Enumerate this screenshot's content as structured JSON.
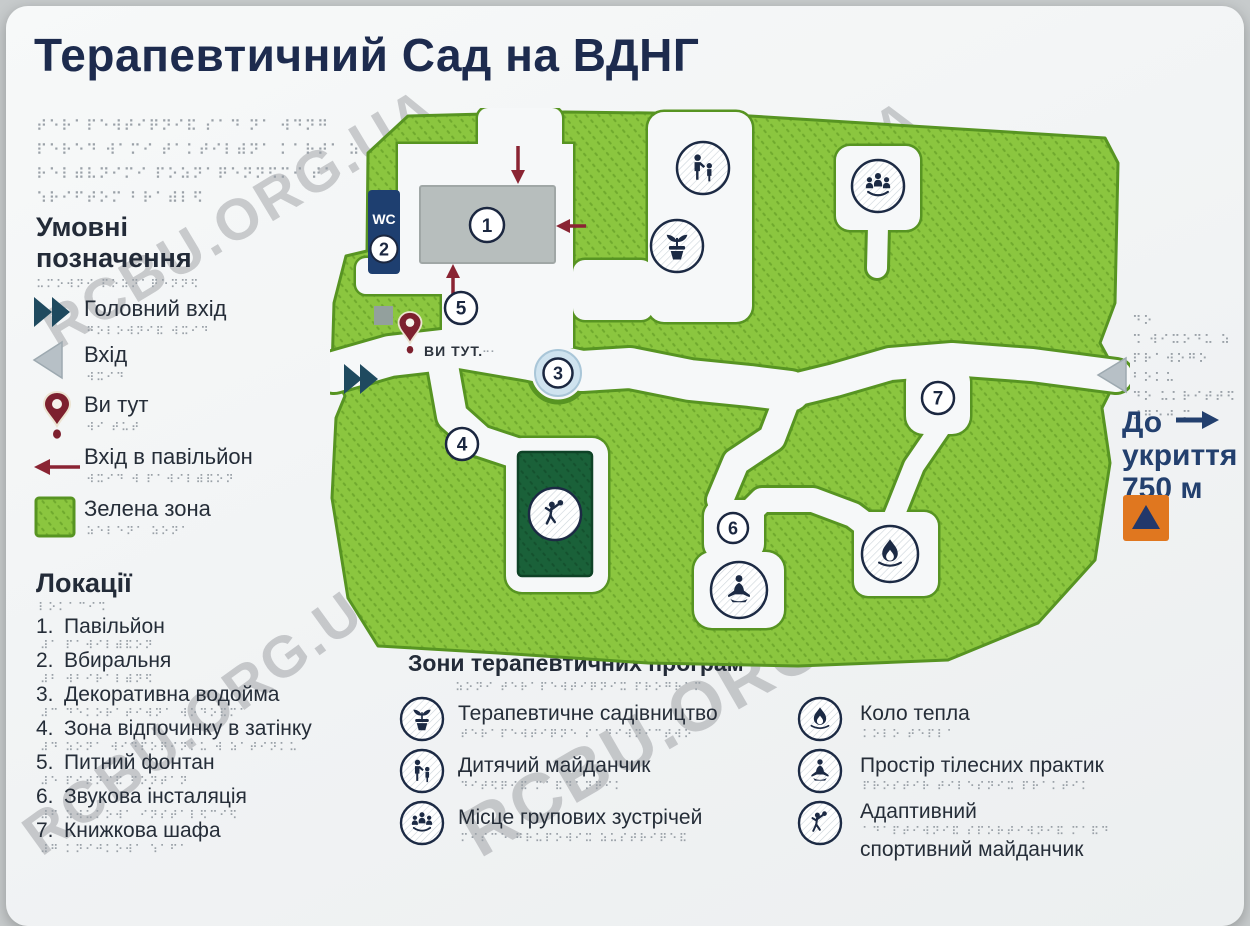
{
  "title": "Терапевтичний Сад на ВДНГ",
  "watermark": {
    "text": "RCBU.ORG.UA"
  },
  "colors": {
    "green_zone": "#8bc63f",
    "green_edge": "#579422",
    "dark_green_lawn": "#1a6139",
    "navy": "#1e3f70",
    "dark_red": "#8a2433",
    "pond_blue": "#cfe3ef",
    "path_white": "#f6f8f9",
    "gray_triangle": "#b7c0c6",
    "building_gray": "#b7bebd",
    "shelter_orange": "#e0771f"
  },
  "legend": {
    "braille_intro": [
      "⠞⠑⠗⠁⠏⠑⠺⠞⠊⠟⠝⠊⠯ ⠎⠁⠙ ⠝⠁ ⠺⠙⠝⠛",
      "⠏⠑⠗⠑⠙ ⠺⠁⠍⠊ ⠞⠁⠅⠞⠊⠇⠾⠝⠁ ⠅⠁⠗⠞⠁ ⠵",
      "⠗⠑⠇⠾⠧⠝⠊⠍⠊ ⠏⠕⠵⠝⠁⠟⠑⠝⠝⠫⠍⠊ ⠞⠁",
      "⠱⠗⠊⠋⠞⠕⠍ ⠃⠗⠁⠾⠇⠫"
    ],
    "heading": "Умовні позначення",
    "heading_braille": "⠥⠍⠕⠺⠝⠊ ⠏⠕⠵⠝⠁⠟⠑⠝⠝⠫",
    "items": [
      {
        "label": "Головний вхід",
        "braille": "⠛⠕⠇⠕⠺⠝⠊⠯ ⠺⠭⠊⠙",
        "icon": "double-arrow-icon"
      },
      {
        "label": "Вхід",
        "braille": "⠺⠭⠊⠙",
        "icon": "gray-triangle-icon"
      },
      {
        "label": "Ви тут",
        "braille": "⠺⠊ ⠞⠥⠞",
        "icon": "map-pin-icon"
      },
      {
        "label": "Вхід в павільйон",
        "braille": "⠺⠭⠊⠙ ⠺ ⠏⠁⠺⠊⠇⠾⠯⠕⠝",
        "icon": "red-arrow-icon"
      },
      {
        "label": "Зелена зона",
        "braille": "⠵⠑⠇⠑⠝⠁ ⠵⠕⠝⠁",
        "icon": "green-square-icon"
      }
    ]
  },
  "locations": {
    "heading": "Локації",
    "heading_braille": "⠇⠕⠅⠁⠉⠊⠩",
    "items": [
      {
        "number": "1.",
        "label": "Павільйон",
        "braille": "⠼⠁ ⠏⠁⠺⠊⠇⠾⠯⠕⠝"
      },
      {
        "number": "2.",
        "label": "Вбиральня",
        "braille": "⠼⠃ ⠺⠃⠊⠗⠁⠇⠾⠝⠫"
      },
      {
        "number": "3.",
        "label": "Декоративна водойма",
        "braille": "⠼⠉ ⠙⠑⠅⠕⠗⠁⠞⠊⠺⠝⠁ ⠺⠕⠙⠕⠯⠍⠁"
      },
      {
        "number": "4.",
        "label": "Зона відпочинку в затінку",
        "braille": "⠼⠙ ⠵⠕⠝⠁ ⠺⠊⠙⠏⠕⠟⠊⠝⠅⠥ ⠺ ⠵⠁⠞⠊⠝⠅⠥"
      },
      {
        "number": "5.",
        "label": "Питний фонтан",
        "braille": "⠼⠑ ⠏⠊⠞⠝⠊⠯ ⠋⠕⠝⠞⠁⠝"
      },
      {
        "number": "6.",
        "label": "Звукова інсталяція",
        "braille": "⠼⠋ ⠵⠺⠥⠅⠕⠺⠁ ⠊⠝⠎⠞⠁⠇⠫⠉⠊⠫"
      },
      {
        "number": "7.",
        "label": "Книжкова шафа",
        "braille": "⠼⠛ ⠅⠝⠊⠚⠅⠕⠺⠁ ⠱⠁⠋⠁"
      }
    ]
  },
  "programs": {
    "heading": "Зони терапевтичних програм",
    "heading_braille": "⠵⠕⠝⠊ ⠞⠑⠗⠁⠏⠑⠺⠞⠊⠟⠝⠊⠭ ⠏⠗⠕⠛⠗⠁⠍",
    "items": [
      {
        "label": "Терапевтичне садівництво",
        "braille": "⠞⠑⠗⠁⠏⠑⠺⠞⠊⠟⠝⠑ ⠎⠁⠙⠊⠺⠝⠊⠉⠞⠺⠕",
        "icon": "plant-pot-icon"
      },
      {
        "label": "Дитячий майданчик",
        "braille": "⠙⠊⠞⠫⠟⠊⠯ ⠍⠁⠯⠙⠁⠝⠟⠊⠅",
        "icon": "children-icon"
      },
      {
        "label": "Місце групових зустрічей",
        "braille": "⠍⠊⠎⠉⠑ ⠛⠗⠥⠏⠕⠺⠊⠭ ⠵⠥⠎⠞⠗⠊⠟⠑⠯",
        "icon": "group-meeting-icon"
      },
      {
        "label": "Коло тепла",
        "braille": "⠅⠕⠇⠕ ⠞⠑⠏⠇⠁",
        "icon": "warmth-fire-icon"
      },
      {
        "label": "Простір тілесних практик",
        "braille": "⠏⠗⠕⠎⠞⠊⠗ ⠞⠊⠇⠑⠎⠝⠊⠭ ⠏⠗⠁⠅⠞⠊⠅",
        "icon": "yoga-icon"
      },
      {
        "label": "Адаптивний",
        "label2": "спортивний майданчик",
        "braille": "⠁⠙⠁⠏⠞⠊⠺⠝⠊⠯ ⠎⠏⠕⠗⠞⠊⠺⠝⠊⠯ ⠍⠁⠯⠙",
        "icon": "adaptive-sport-icon"
      }
    ]
  },
  "shelter": {
    "braille": [
      "⠙⠕",
      "⠩ ⠺⠊⠭⠕⠙⠥ ⠵",
      "⠏⠗⠁⠺⠕⠛⠕ ⠃⠕⠅⠥",
      "⠙⠕ ⠥⠅⠗⠊⠞⠞⠫",
      "⠼⠛⠑⠚ ⠍"
    ],
    "line1": "До",
    "line2": "укриття",
    "line3": "750 м"
  },
  "map": {
    "wc_label": "WC",
    "you_are_here": "ВИ ТУТ.",
    "you_are_here_braille": "⠒⠂",
    "markers": [
      "1",
      "2",
      "3",
      "4",
      "5",
      "6",
      "7"
    ]
  }
}
